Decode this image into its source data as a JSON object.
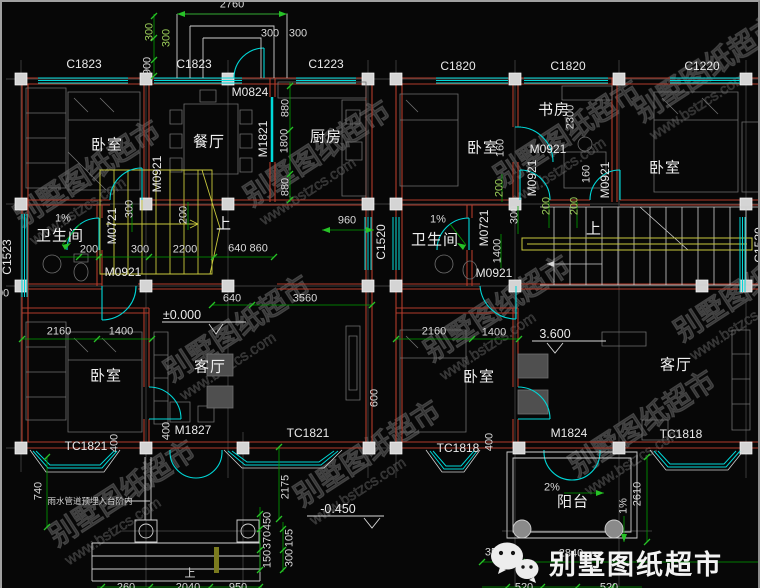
{
  "watermark": {
    "brand": "别墅图纸超市",
    "site": "www.bstzcs.com"
  },
  "logo": {
    "brand": "别墅图纸超市"
  },
  "note": {
    "drain": "雨水管道预埋入台阶内"
  },
  "levels": {
    "ground": "±0.000",
    "porch": "-0.450",
    "upper": "3.600"
  },
  "stairs": {
    "up_left": "上",
    "up_right": "上",
    "up_porch": "上"
  },
  "slopes": {
    "bath_left": "1%",
    "bath_right": "1%",
    "balcony": "2%",
    "balcony_side": "1%"
  },
  "rooms": {
    "bedroom_l1": "卧室",
    "dining": "餐厅",
    "kitchen": "厨房",
    "bath_l": "卫生间",
    "bedroom_l2": "卧室",
    "living_l": "客厅",
    "bedroom_r1": "卧室",
    "study": "书房",
    "bedroom_r2": "卧室",
    "bath_r": "卫生间",
    "bedroom_r3": "卧室",
    "living_r": "客厅",
    "balcony": "阳台"
  },
  "windows": {
    "c1823_1": "C1823",
    "c1823_2": "C1823",
    "c1223": "C1223",
    "c1820_1": "C1820",
    "c1820_2": "C1820",
    "c1220": "C1220",
    "c1523": "C1523",
    "c1520_mid": "C1520",
    "c1520_right": "C1520",
    "tc1821_1": "TC1821",
    "tc1821_2": "TC1821",
    "tc1818_1": "TC1818",
    "tc1818_2": "TC1818"
  },
  "doors": {
    "m0824": "M0824",
    "m1821": "M1821",
    "m0921_a": "M0921",
    "m0921_b": "M0921",
    "m0721_l": "M0721",
    "m1827": "M1827",
    "m0921_r1": "M0921",
    "m0921_r2": "M0921",
    "m0921_r3": "M0921",
    "m0921_r4": "M0921",
    "m0721_r": "M0721",
    "m1824": "M1824"
  },
  "dims": {
    "w2760": "2760",
    "v300a": "300",
    "v300b": "300",
    "v900": "900",
    "t300a": "300",
    "t300b": "300",
    "v880a": "880",
    "v1800": "1800",
    "v880b": "880",
    "v2300": "2300",
    "v160a": "160",
    "v160b": "160",
    "v300c": "300",
    "v200a": "200",
    "m200": "200",
    "m300": "300",
    "m2200": "2200",
    "m640860": "640 860",
    "w960": "960",
    "b640": "640",
    "b3560": "3560",
    "l2160": "2160",
    "l1400": "1400",
    "r2160": "2160",
    "r1400": "1400",
    "v200b": "200",
    "v200c": "200",
    "v200d": "200",
    "v300d": "300",
    "v1400": "1400",
    "v600": "600",
    "v400a": "400",
    "v400b": "400",
    "v400c": "400",
    "v740": "740",
    "v2175": "2175",
    "v450": "450",
    "v370": "370",
    "v150": "150",
    "v105": "105",
    "v300e": "300",
    "v2610": "2610",
    "b350": "350",
    "b2840": "2840",
    "b520a": "520",
    "b520b": "520",
    "b260": "260",
    "b2040": "2040",
    "b950": "950",
    "edge300": "300"
  }
}
